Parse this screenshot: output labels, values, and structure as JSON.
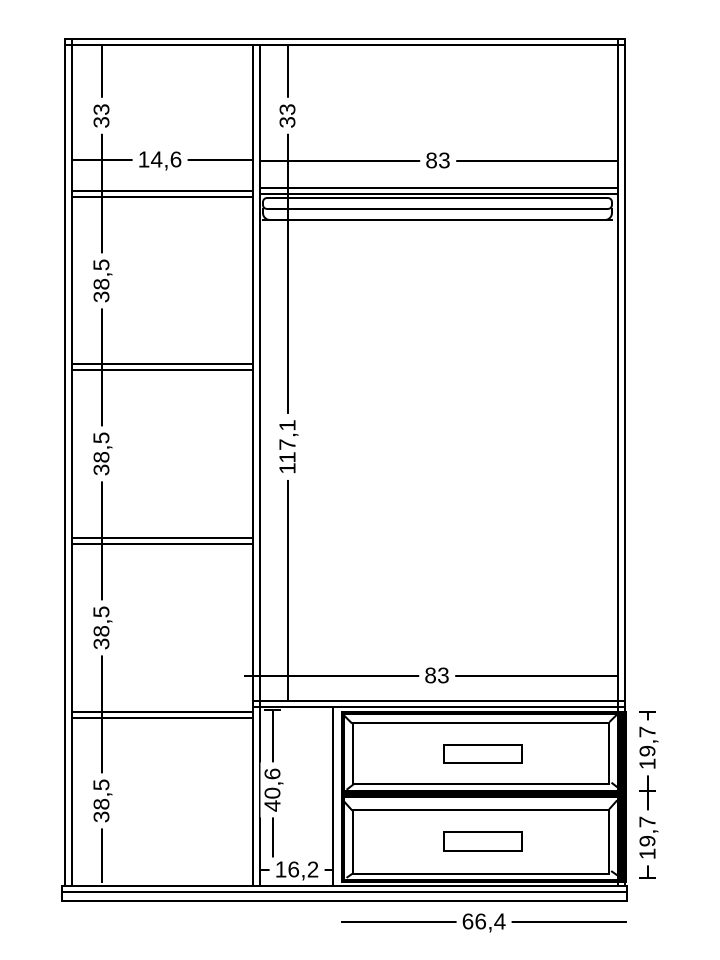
{
  "drawing": {
    "type": "wardrobe-front-elevation-technical-drawing",
    "line_color": "#000000",
    "background_color": "#ffffff",
    "left_column": {
      "top_section_height": "33",
      "column_width": "14,6",
      "shelf_sections": [
        "38,5",
        "38,5",
        "38,5",
        "38,5"
      ]
    },
    "right_column": {
      "top_section_height": "33",
      "interior_width_top": "83",
      "hanging_space_height": "117,1",
      "interior_width_bottom": "83"
    },
    "drawer_section": {
      "side_gap_height": "40,6",
      "side_gap_width": "16,2",
      "drawer_heights": [
        "19,7",
        "19,7"
      ],
      "unit_width": "66,4"
    }
  }
}
